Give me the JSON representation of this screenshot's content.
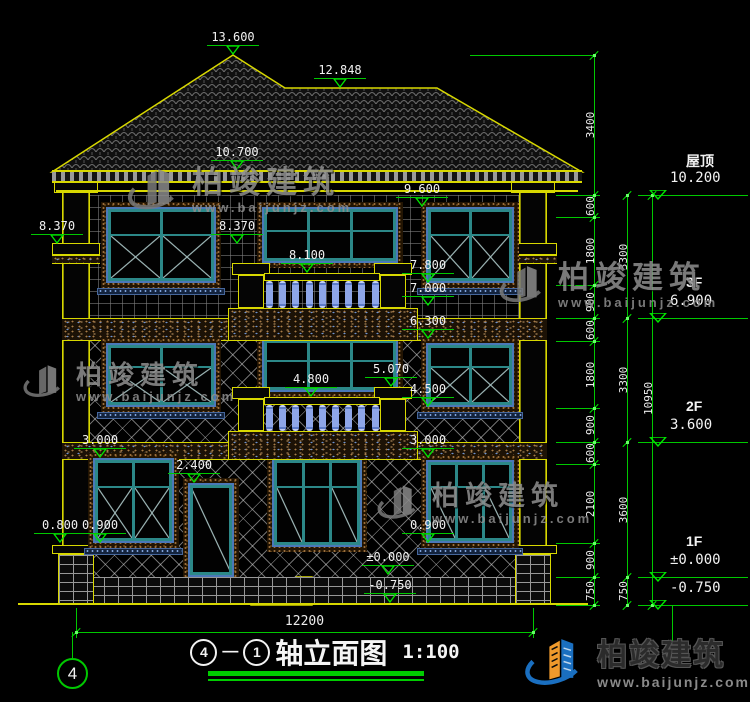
{
  "title_block": {
    "axis_a": "4",
    "dash": "—",
    "axis_b": "1",
    "name": "轴立面图",
    "scale": "1:100"
  },
  "axis_bubble": {
    "label": "4"
  },
  "watermark": {
    "title": "柏竣建筑",
    "url": "www.baijunjz.com"
  },
  "footer_logo": {
    "title": "柏竣建筑",
    "url": "www.baijunjz.com"
  },
  "colors": {
    "line_green": "#00c800",
    "cad_yellow": "#d8d800",
    "window_teal": "#2c8888",
    "baluster_blue": "#8ea6e8",
    "dim_text": "#ececec"
  },
  "figure": {
    "walls": [
      {
        "n": "wall-3f",
        "x": 62,
        "y": 195,
        "w": 485,
        "h": 123,
        "p": "grid"
      },
      {
        "n": "wall-2f",
        "x": 62,
        "y": 341,
        "w": 485,
        "h": 101,
        "p": "lat"
      },
      {
        "n": "wall-1f",
        "x": 62,
        "y": 460,
        "w": 485,
        "h": 117,
        "p": "lat"
      },
      {
        "n": "plinth",
        "x": 62,
        "y": 577,
        "w": 485,
        "h": 27,
        "p": "brick"
      }
    ],
    "bands": [
      {
        "n": "floor-band-3f-2f",
        "x": 62,
        "y": 318,
        "w": 485,
        "h": 23
      },
      {
        "n": "floor-band-2f-1f",
        "x": 62,
        "y": 442,
        "w": 485,
        "h": 18
      }
    ],
    "cornice": {
      "x": 52,
      "y": 170,
      "w": 530,
      "h": 13,
      "line_y": 190
    },
    "ground_line": {
      "x": 18,
      "y": 603,
      "w": 570,
      "h": 2
    },
    "columns": [
      {
        "x": 62
      },
      {
        "x": 519
      }
    ],
    "balconies": [
      {
        "slab": {
          "x": 228,
          "y": 308,
          "w": 190,
          "h": 33
        },
        "rail_y": 273,
        "bal_y": 281,
        "bal_h": 27,
        "cap_y": 263,
        "body_y": 275,
        "body_h": 33
      },
      {
        "slab": {
          "x": 228,
          "y": 431,
          "w": 190,
          "h": 29
        },
        "rail_y": 397,
        "bal_y": 405,
        "bal_h": 26,
        "cap_y": 387,
        "body_y": 399,
        "body_h": 32
      }
    ],
    "windows": [
      {
        "x": 106,
        "y": 207,
        "w": 110,
        "h": 76,
        "cols": 2,
        "tr": 0.32,
        "glz": "x",
        "sill": true
      },
      {
        "x": 262,
        "y": 207,
        "w": 136,
        "h": 56,
        "cols": 3,
        "tr": 0.38,
        "glz": "plain",
        "sill": false
      },
      {
        "x": 426,
        "y": 207,
        "w": 88,
        "h": 76,
        "cols": 2,
        "tr": 0.32,
        "glz": "x",
        "sill": true
      },
      {
        "x": 106,
        "y": 343,
        "w": 110,
        "h": 64,
        "cols": 2,
        "tr": 0.32,
        "glz": "x",
        "sill": true
      },
      {
        "x": 262,
        "y": 338,
        "w": 136,
        "h": 54,
        "cols": 3,
        "tr": 0.38,
        "glz": "plain",
        "sill": false
      },
      {
        "x": 426,
        "y": 343,
        "w": 88,
        "h": 64,
        "cols": 2,
        "tr": 0.32,
        "glz": "x",
        "sill": true
      },
      {
        "x": 93,
        "y": 458,
        "w": 81,
        "h": 85,
        "cols": 2,
        "tr": 0.3,
        "glz": "x",
        "sill": true
      },
      {
        "x": 272,
        "y": 458,
        "w": 90,
        "h": 89,
        "cols": 3,
        "tr": 0.28,
        "glz": "sides",
        "sill": false
      },
      {
        "x": 426,
        "y": 460,
        "w": 88,
        "h": 83,
        "cols": 3,
        "tr": 0.28,
        "glz": "sides",
        "sill": true
      }
    ],
    "door": {
      "x": 188,
      "y": 483,
      "w": 46,
      "h": 94
    },
    "roof_pts": "52,172 233,55 285,88 437,88 582,172",
    "steps_path": "M312,577 L296,577 L296,585 L281,585 L281,593 L266,593 L266,601 L251,601 L251,605 L312,605 Z",
    "elevation_markers": [
      {
        "t": "13.600",
        "x": 233,
        "y": 57
      },
      {
        "t": "12.848",
        "x": 340,
        "y": 90
      },
      {
        "t": "10.700",
        "x": 237,
        "y": 172
      },
      {
        "t": "9.600",
        "x": 422,
        "y": 209
      },
      {
        "t": "8.370",
        "x": 57,
        "y": 246
      },
      {
        "t": "8.370",
        "x": 237,
        "y": 246
      },
      {
        "t": "8.100",
        "x": 307,
        "y": 275
      },
      {
        "t": "7.800",
        "x": 428,
        "y": 285
      },
      {
        "t": "7.000",
        "x": 428,
        "y": 308
      },
      {
        "t": "6.300",
        "x": 428,
        "y": 341
      },
      {
        "t": "5.070",
        "x": 391,
        "y": 389
      },
      {
        "t": "4.800",
        "x": 311,
        "y": 399
      },
      {
        "t": "4.500",
        "x": 428,
        "y": 409
      },
      {
        "t": "3.000",
        "x": 100,
        "y": 460
      },
      {
        "t": "3.000",
        "x": 428,
        "y": 460
      },
      {
        "t": "2.400",
        "x": 194,
        "y": 485
      },
      {
        "t": "0.900",
        "x": 100,
        "y": 545
      },
      {
        "t": "0.800",
        "x": 60,
        "y": 545
      },
      {
        "t": "0.900",
        "x": 428,
        "y": 545
      },
      {
        "t": "±0.000",
        "x": 388,
        "y": 577
      },
      {
        "t": "-0.750",
        "x": 390,
        "y": 605
      }
    ],
    "dim_chains": [
      {
        "x": 594,
        "segs": [
          [
            "3400",
            55,
            195
          ],
          [
            "600",
            195,
            217
          ],
          [
            "1800",
            217,
            285
          ],
          [
            "900",
            285,
            318
          ],
          [
            "600",
            318,
            341
          ],
          [
            "1800",
            341,
            408
          ],
          [
            "900",
            408,
            442
          ],
          [
            "600",
            442,
            464
          ],
          [
            "2100",
            464,
            543
          ],
          [
            "900",
            543,
            577
          ],
          [
            "750",
            577,
            605
          ]
        ]
      },
      {
        "x": 627,
        "segs": [
          [
            "3300",
            195,
            318
          ],
          [
            "3300",
            318,
            442
          ],
          [
            "3600",
            442,
            577
          ],
          [
            "750",
            577,
            605
          ]
        ]
      },
      {
        "x": 652,
        "segs": [
          [
            "10950",
            195,
            605
          ]
        ]
      }
    ],
    "ext_lines": [
      {
        "x": 470,
        "y": 55,
        "w": 124
      },
      {
        "x": 556,
        "y": 195,
        "w": 44
      },
      {
        "x": 556,
        "y": 217,
        "w": 44
      },
      {
        "x": 556,
        "y": 285,
        "w": 44
      },
      {
        "x": 556,
        "y": 318,
        "w": 44
      },
      {
        "x": 556,
        "y": 341,
        "w": 44
      },
      {
        "x": 556,
        "y": 408,
        "w": 44
      },
      {
        "x": 556,
        "y": 442,
        "w": 44
      },
      {
        "x": 556,
        "y": 464,
        "w": 44
      },
      {
        "x": 556,
        "y": 543,
        "w": 44
      },
      {
        "x": 556,
        "y": 577,
        "w": 44
      },
      {
        "x": 556,
        "y": 605,
        "w": 44
      },
      {
        "x": 672,
        "y": 605,
        "h": 45
      },
      {
        "x": 76,
        "y": 608,
        "h": 30
      },
      {
        "x": 533,
        "y": 608,
        "h": 30
      }
    ],
    "levels_right": [
      {
        "name": "屋顶",
        "elev": "10.200",
        "y": 195
      },
      {
        "name": "3F",
        "elev": "6.900",
        "y": 318
      },
      {
        "name": "2F",
        "elev": "3.600",
        "y": 442
      },
      {
        "name": "1F",
        "elev": "±0.000",
        "y": 577
      },
      {
        "name": "",
        "elev": "-0.750",
        "y": 605
      }
    ],
    "bottom_dim": {
      "label": "12200",
      "x1": 76,
      "x2": 533,
      "y": 632
    },
    "watermarks": [
      {
        "x": 126,
        "y": 160,
        "logo": 58,
        "fs": 31
      },
      {
        "x": 22,
        "y": 358,
        "logo": 46,
        "fs": 26
      },
      {
        "x": 498,
        "y": 258,
        "logo": 52,
        "fs": 31
      },
      {
        "x": 376,
        "y": 478,
        "logo": 48,
        "fs": 27
      }
    ]
  }
}
